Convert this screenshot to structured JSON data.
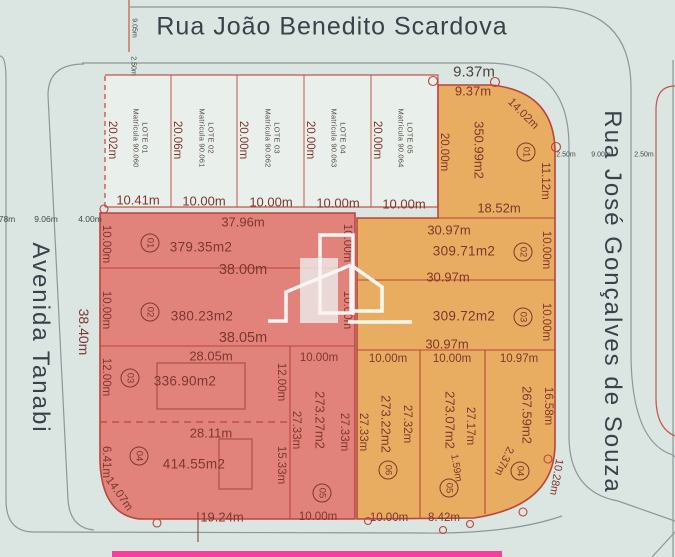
{
  "street_top": {
    "name": "Rua João Benedito Scardova",
    "road_width": "9.05m",
    "sidewalk": "2.50m"
  },
  "street_left": {
    "name": "Avenida Tanabi",
    "partial": "78m",
    "road_width": "9.06m",
    "sidewalk": "4.00m",
    "frontage": "38.40m"
  },
  "street_right": {
    "name": "Rua José Gonçalves de Souza",
    "sidewalk_w": "2.50m",
    "road_width": "9.00m",
    "sidewalk_e": "2.50m"
  },
  "upper_lots": {
    "lots": [
      {
        "name": "LOTE 01",
        "matricula": "Matrícula 90.060",
        "width": "10.41m",
        "height": "20.02m"
      },
      {
        "name": "LOTE 02",
        "matricula": "Matrícula 90.061",
        "width": "10.00m",
        "height": "20.06m"
      },
      {
        "name": "LOTE 03",
        "matricula": "Matrícula 90.062",
        "width": "10.00m",
        "height": "20.00m"
      },
      {
        "name": "LOTE 04",
        "matricula": "Matrícula 90.063",
        "width": "10.00m",
        "height": "20.00m"
      },
      {
        "name": "LOTE 05",
        "matricula": "Matrícula 90.064",
        "width": "10.00m",
        "height": "20.00m"
      }
    ]
  },
  "quadra_a": {
    "lot1": {
      "num": "01",
      "area": "379.35m2",
      "top": "37.96m",
      "bottom": "38.00m",
      "left": "10.00m",
      "right": "10.00m"
    },
    "lot2": {
      "num": "02",
      "area": "380.23m2",
      "bottom": "38.05m",
      "left": "10.00m",
      "right": "10.00m"
    },
    "lot3": {
      "num": "03",
      "area": "336.90m2",
      "top": "28.05m",
      "left": "12.00m",
      "right": "12.00m"
    },
    "lot4": {
      "num": "04",
      "area": "414.55m2",
      "top": "28.11m",
      "left": "6.41m",
      "right": "15.33m",
      "corner": "14.07m",
      "bottom": "19.24m"
    },
    "lot5": {
      "num": "05",
      "area": "273.27m2",
      "top": "10.00m",
      "left": "27.33m",
      "right": "27.33m",
      "bottom": "10.00m"
    }
  },
  "quadra_b": {
    "lot1": {
      "num": "01",
      "street_front": "9.37m",
      "top": "9.37m",
      "left": "20.00m",
      "corner": "14.02m",
      "right": "11.12m",
      "bottom": "18.52m",
      "area": "350.99m2"
    },
    "lot2": {
      "num": "02",
      "top": "30.97m",
      "area": "309.71m2",
      "right": "10.00m",
      "bottom": "30.97m"
    },
    "lot3": {
      "num": "03",
      "area": "309.72m2",
      "right": "10.00m",
      "bottom": "30.97m"
    },
    "lot6": {
      "num": "06",
      "top": "10.00m",
      "area": "273.22m2",
      "left": "27.33m",
      "right": "27.32m",
      "bottom": "10.00m"
    },
    "lot5": {
      "num": "05",
      "top": "10.00m",
      "area": "273.07m2",
      "right": "27.17m",
      "sliver": "1.59m",
      "bottom": "8.42m"
    },
    "lot4": {
      "num": "04",
      "top": "10.97m",
      "area": "267.59m2",
      "right": "16.58m",
      "side": "2.37m",
      "corner": "10.28m"
    }
  },
  "colors": {
    "block_a_fill": "#e2837b",
    "block_b_fill": "#e9ad62",
    "lot_border": "#b9453c",
    "highlight_bar": "#f73f9e",
    "background": "#dbe5e1"
  }
}
